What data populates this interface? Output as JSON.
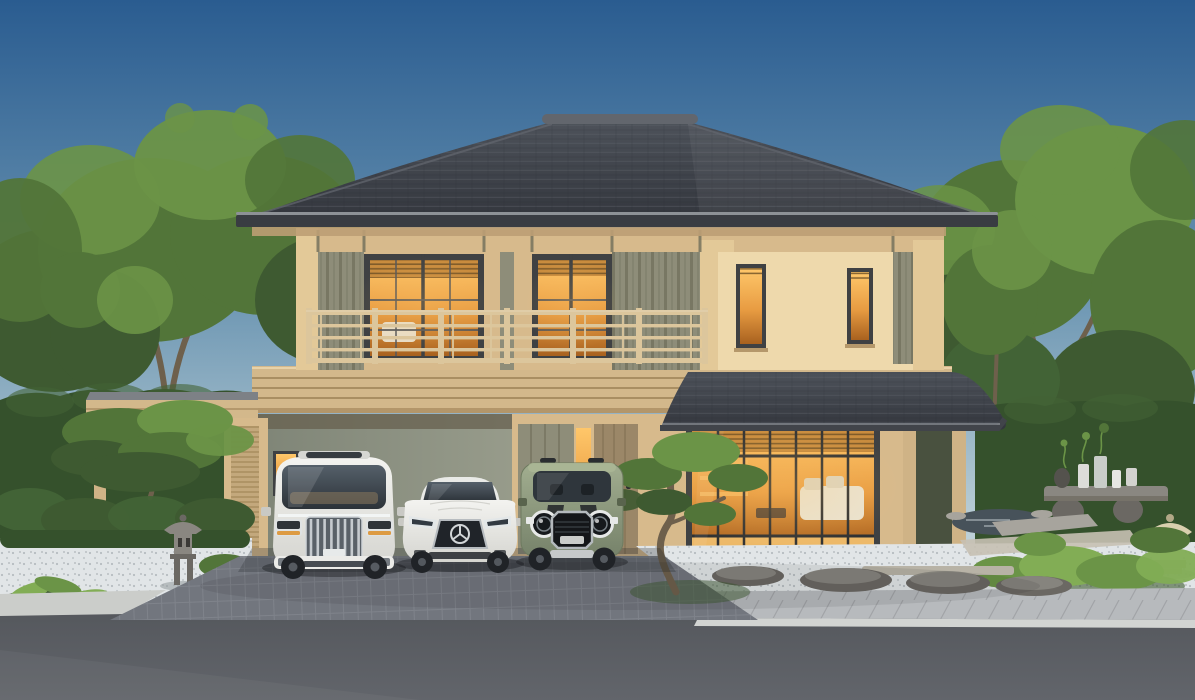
{
  "scene": {
    "type": "exterior architectural rendering",
    "description": "Front elevation of a modern two-storey Japanese-style house at dusk: charcoal hip tile roof, beige walls with olive board-and-batten panels, full-width balcony with champagne railing, warm-lit interiors, a carport with three parked cars, zen gardens with stone lanterns on both sides, paver driveway and asphalt street in the foreground.",
    "sky": "clear gradient blue sky",
    "lighting": "warm interior light glowing through all glazing"
  },
  "house": {
    "roof": "charcoal concrete-tile hip roof with ridge cap",
    "walls": "warm beige stucco with olive vertical board-and-batten panels",
    "balcony": "second-floor balcony with champagne metal railing",
    "upper_openings": [
      "wide lit sliding glass door",
      "narrow lit sliding glass door",
      "small lit window",
      "small lit window"
    ],
    "ground_floor": [
      "three-bay carport with lit service window",
      "olive sliding panel",
      "lit amber sidelight",
      "timber front door with black pull handle",
      "floor-to-ceiling lit living room glazing with sofa",
      "covered porch on timber posts",
      "timber deck"
    ],
    "secondary_roof": "lower tiled porch roof over living room"
  },
  "vehicles": [
    {
      "name": "white luxury minivan",
      "details": "chrome vertical-slat grille, slim LED lamps, dark panoramic windshield, sunroof"
    },
    {
      "name": "white coupe sedan",
      "details": "black grille with three-pointed-star emblem, slanted headlamps"
    },
    {
      "name": "sage green compact SUV",
      "details": "black bonnet stripes, round ringed headlamps, octagonal black grille, roof rails"
    }
  ],
  "garden": {
    "left": [
      "clipped niwaki pine",
      "boxwood mounds",
      "granite pagoda stone lantern",
      "white pebble bed",
      "broadleaf foreground plants"
    ],
    "right": [
      "koi pond edge",
      "stone display table with ceramic vases and jars",
      "stone bench slabs",
      "cream pagoda lantern",
      "clipped bright shrubs",
      "flat grey landscape rocks",
      "white pebble bed"
    ],
    "center": [
      "sculpted bonsai pine beside front door"
    ]
  },
  "street": [
    "dark paver driveway apron",
    "flat stepping stones",
    "light concrete sidewalk with curb",
    "asphalt road"
  ],
  "trees": "mature green deciduous trees and tall clipped hedges enclosing the plot",
  "palette": {
    "sky_top": "#2a5c90",
    "sky_mid": "#6b95b2",
    "sky_low": "#b9cdd5",
    "sky_horizon": "#d6e0e3",
    "foliage_dark": "#3e5a31",
    "foliage": "#527539",
    "foliage_light": "#6b9447",
    "foliage_bright": "#82ad55",
    "trunk": "#6e604c",
    "hedge": "#35512c",
    "hedge_light": "#426336",
    "roof": "#33363d",
    "roof_light": "#4d525a",
    "roof_edge": "#62666d",
    "roof_fascia": "#393c42",
    "gutter": "#8d9196",
    "soffit": "#bd9f74",
    "wall_tan": "#d7ba8c",
    "wall_tan_light": "#e3c998",
    "wall_cream": "#eed9ac",
    "panel_olive": "#8e8d79",
    "batten_dark": "#6f6e5a",
    "frame_dark": "#3f4143",
    "glass_warm_hi": "#ffc76a",
    "glass_warm": "#e89c42",
    "glass_warm_deep": "#a8611f",
    "band": "#d3b88b",
    "band_groove": "#a98e62",
    "band_hi": "#e8d2a8",
    "railing": "#dcc69c",
    "carport_shadow": "#67604f",
    "door_wood": "#9b8768",
    "door_groove": "#7f6c50",
    "post": "#cfb386",
    "deck": "#d9c49c",
    "deck_edge": "#b7a179",
    "porch_dark": "#49513f",
    "gravel": "#e1e5e7",
    "paver": "#72767e",
    "paver_line": "#8d9199",
    "sidewalk": "#b7babd",
    "curb": "#cbcdca",
    "road": "#54575c",
    "stone": "#8a8781",
    "stone_dark": "#6b6863",
    "stone_light": "#a7a49d",
    "lantern_cream": "#d9cfae",
    "lantern_cream_dark": "#b2a887",
    "pond": "#47525a",
    "car_white": "#ebebe8",
    "car_white_dark": "#c9c9c4",
    "car_glass": "#333b42",
    "chrome": "#ccd1d5",
    "car_green": "#93a07f",
    "car_green_dark": "#747f64",
    "tire": "#202327",
    "sofa": "#eae3d1"
  }
}
